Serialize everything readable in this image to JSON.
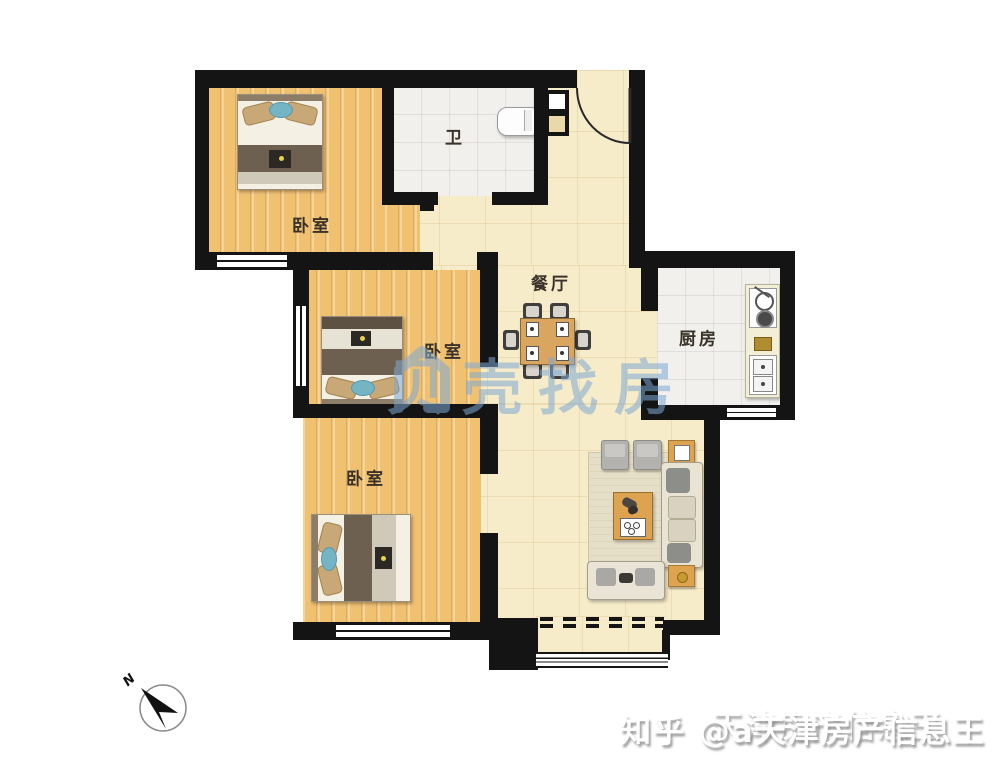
{
  "rooms": {
    "bedroom_top": {
      "label": "卧室"
    },
    "bedroom_middle": {
      "label": "卧室"
    },
    "bedroom_bottom": {
      "label": "卧室"
    },
    "bathroom": {
      "label": "卫"
    },
    "dining": {
      "label": "餐厅"
    },
    "kitchen": {
      "label": "厨房"
    }
  },
  "watermarks": {
    "beike_text": "贝壳找房",
    "zhihu_text": "知乎 @a天津房产信息王",
    "zhihu_ghost": "天津房产信息王"
  },
  "compass": {
    "north_label": "N"
  },
  "colors": {
    "wall": "#141414",
    "wood_floor": "#f1c172",
    "tile_floor": "#f1f0ec",
    "hall_floor": "#f6ecca",
    "watermark_blue": "#7fa9d4",
    "accent_teal": "#74b4c4",
    "furniture_wood": "#dda350"
  }
}
